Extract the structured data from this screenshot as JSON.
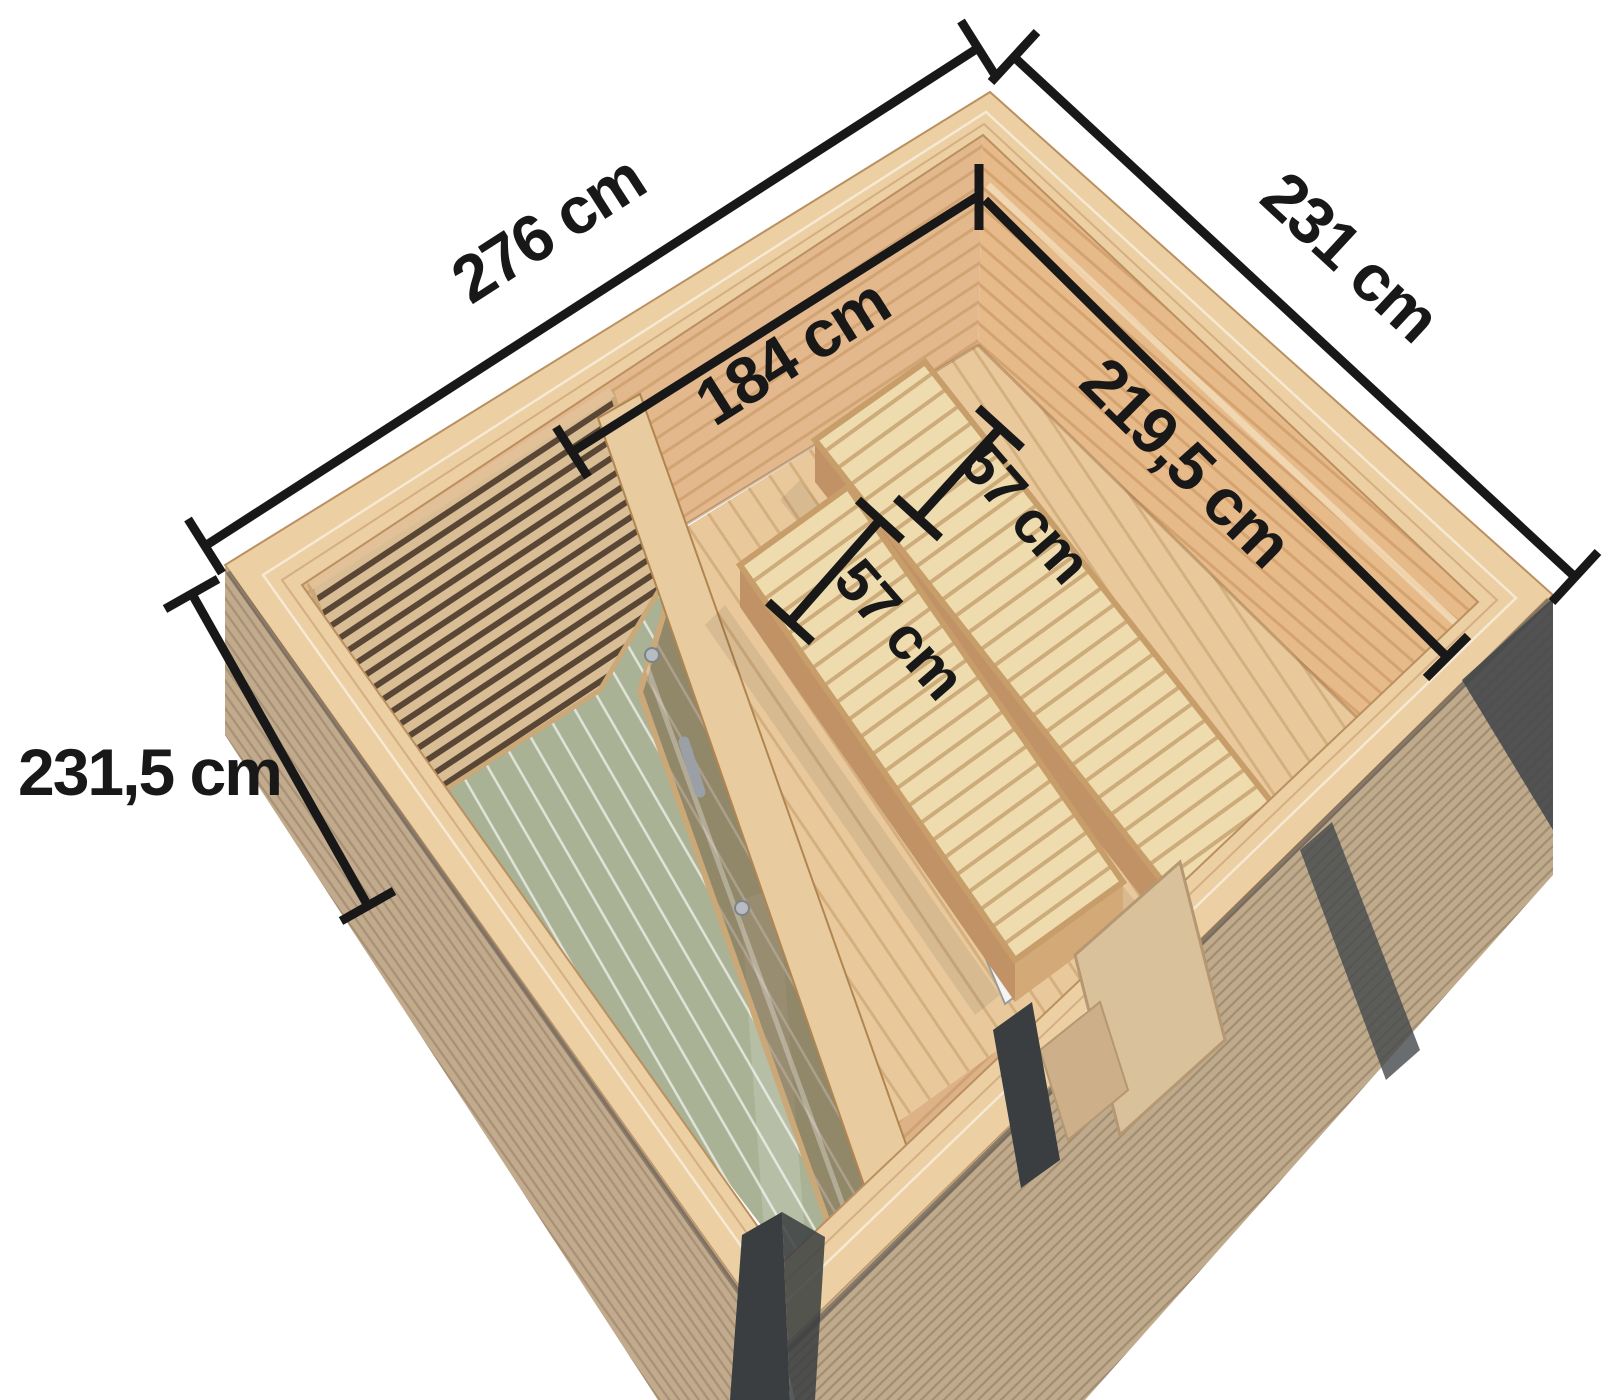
{
  "dimensions": {
    "outer_width": "276 cm",
    "outer_depth": "231 cm",
    "interior_back_width": "184 cm",
    "interior_right_depth": "219,5 cm",
    "bench_right_width": "57 cm",
    "bench_left_width": "57 cm",
    "front_height": "231,5 cm"
  },
  "colors": {
    "background": "#ffffff",
    "dimension_line": "#181818",
    "wood_band": "#eccfa2",
    "wood_wall_left": "#e2b88c",
    "wood_wall_right": "#e7ba8a",
    "wood_floor": "#e9c99c",
    "bench_wood": "#eedcae",
    "deck_green": "#a9b294",
    "exterior_tan": "#bfab8c",
    "anthracite": "#3a3e41",
    "glass_tint": "#7a5c3e",
    "metal": "#9aa0a6"
  }
}
